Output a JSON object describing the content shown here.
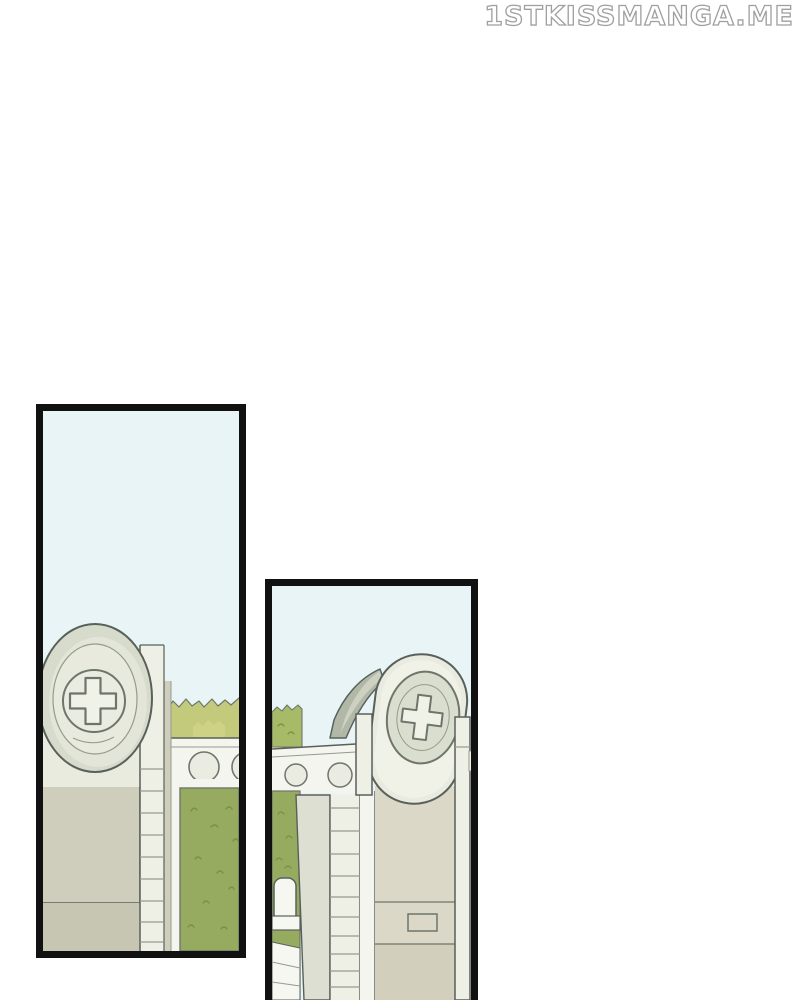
{
  "watermark": {
    "text": "1STKISSMANGA.ME"
  },
  "panels": [
    {
      "id": "panel-1",
      "description": "tall comic panel: gate pillar topped by an oval medallion bearing a medical cross, white wall with round portholes, olive bushes and a green hedge under a pale blue sky",
      "symbol": "medical-cross-icon"
    },
    {
      "id": "panel-2",
      "description": "tall comic panel: closer angled view of the same cross-medallion tower, ladder column, gate posts, hedge and white fence, panel cropped by page bottom",
      "symbol": "medical-cross-icon"
    }
  ],
  "colors": {
    "pageBg": "#ffffff",
    "panelBorder": "#111111",
    "watermarkStroke": "#a0a0a0",
    "sky": "#e8f4f6",
    "ink": "#59605a",
    "inkMid": "#6e766b",
    "inkSoft": "#949b8d",
    "wallWhite": "#f4f5ee",
    "lightBuilding": "#e9ebdf",
    "lightBuilding2": "#dcdfd1",
    "ladderWhite": "#eef0e5",
    "ring": "#d7dbcc",
    "ringLight": "#e2e5d8",
    "ring2": "#dadecf",
    "medInner": "#e7eadd",
    "circleFill": "#eaece1",
    "crossFill": "#f0f2e8",
    "pillarBeige": "#cfcebc",
    "pillarBeigeDark": "#c7c6b2",
    "bodyBeige": "#d2cfbc",
    "bodyBeigeLight": "#dbd8c7",
    "hedge": "#96aa60",
    "hedgeDark": "#78923f",
    "bush": "#c4ca7b",
    "bushLight": "#cdd285",
    "bush2": "#a6ba68",
    "awning": "#ccd1c2",
    "awningDark": "#b2b8a7",
    "capsule": "#e9ebe0",
    "capsuleLight": "#f0f2e8",
    "fenceWhite": "#f6f7f1"
  }
}
